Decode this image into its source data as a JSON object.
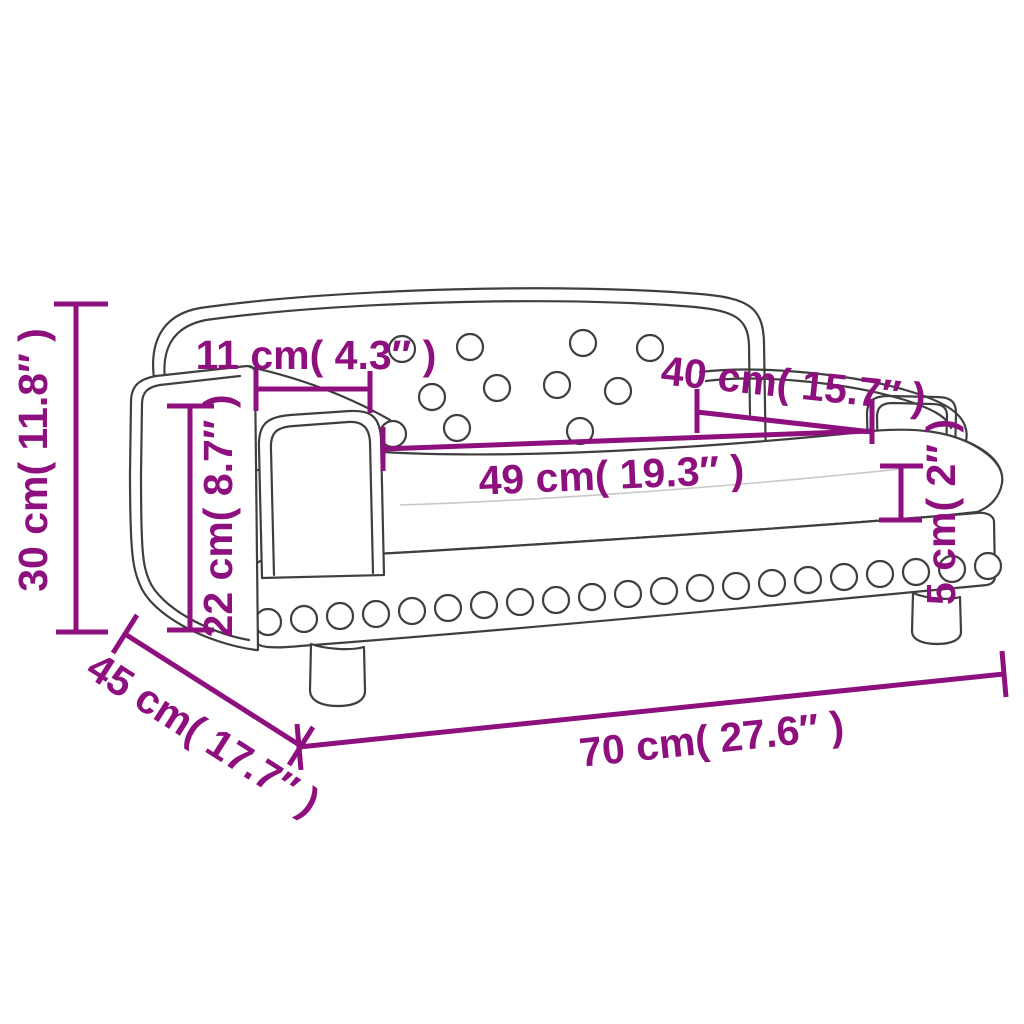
{
  "diagram": {
    "type": "product-dimension-diagram",
    "subject": "kids-sofa-line-drawing",
    "colors": {
      "dimension_annotation": "#8E107E",
      "drawing_outline": "#3F3F3F",
      "background": "#FFFFFF"
    },
    "dimensions": [
      {
        "id": "overall-height",
        "cm": 30,
        "inches": 11.8,
        "label": "30 cm( 11.8″ )"
      },
      {
        "id": "backrest-top-span",
        "cm": 11,
        "inches": 4.3,
        "label": "11 cm( 4.3″ )"
      },
      {
        "id": "armrest-length",
        "cm": 40,
        "inches": 15.7,
        "label": "40 cm( 15.7″ )"
      },
      {
        "id": "seat-width",
        "cm": 49,
        "inches": 19.3,
        "label": "49 cm( 19.3″ )"
      },
      {
        "id": "seat-height",
        "cm": 22,
        "inches": 8.7,
        "label": "22 cm( 8.7″ )"
      },
      {
        "id": "cushion-thickness",
        "cm": 5,
        "inches": 2,
        "label": "5 cm( 2″ )"
      },
      {
        "id": "overall-depth",
        "cm": 45,
        "inches": 17.7,
        "label": "45 cm( 17.7″ )"
      },
      {
        "id": "overall-width",
        "cm": 70,
        "inches": 27.6,
        "label": "70 cm( 27.6″ )"
      }
    ]
  }
}
